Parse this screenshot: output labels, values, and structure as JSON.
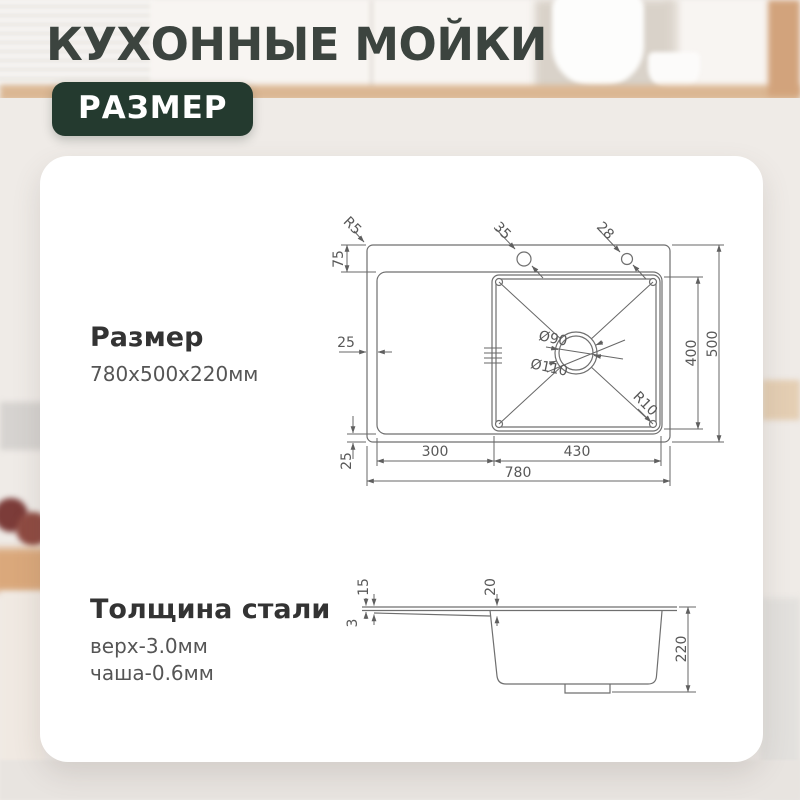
{
  "header": {
    "title": "КУХОННЫЕ МОЙКИ",
    "badge": "РАЗМЕР"
  },
  "card": {
    "size": {
      "heading": "Размер",
      "value": "780x500x220мм"
    },
    "thickness": {
      "heading": "Толщина стали",
      "top": "верх-3.0мм",
      "bowl": "чаша-0.6мм"
    }
  },
  "top_view": {
    "dims": {
      "corner_radius": "R5",
      "rim_top": "75",
      "hole_left": "35",
      "hole_right": "28",
      "rim_left": "25",
      "rim_bottom": "25",
      "drain_inner": "Ø90",
      "drain_outer": "Ø110",
      "bowl_corner_radius": "R10",
      "bowl_length": "400",
      "total_depth": "500",
      "wing_width": "300",
      "bowl_width": "430",
      "total_width": "780"
    }
  },
  "side_view": {
    "dims": {
      "rim_drop": "15",
      "plate_thickness": "3",
      "bowl_edge_drop": "20",
      "height": "220"
    }
  },
  "colors": {
    "badge_bg": "#243a2f",
    "title_text": "#3c443f",
    "card_bg": "#ffffff",
    "line": "#6f6f6f",
    "dim_text": "#585858"
  }
}
